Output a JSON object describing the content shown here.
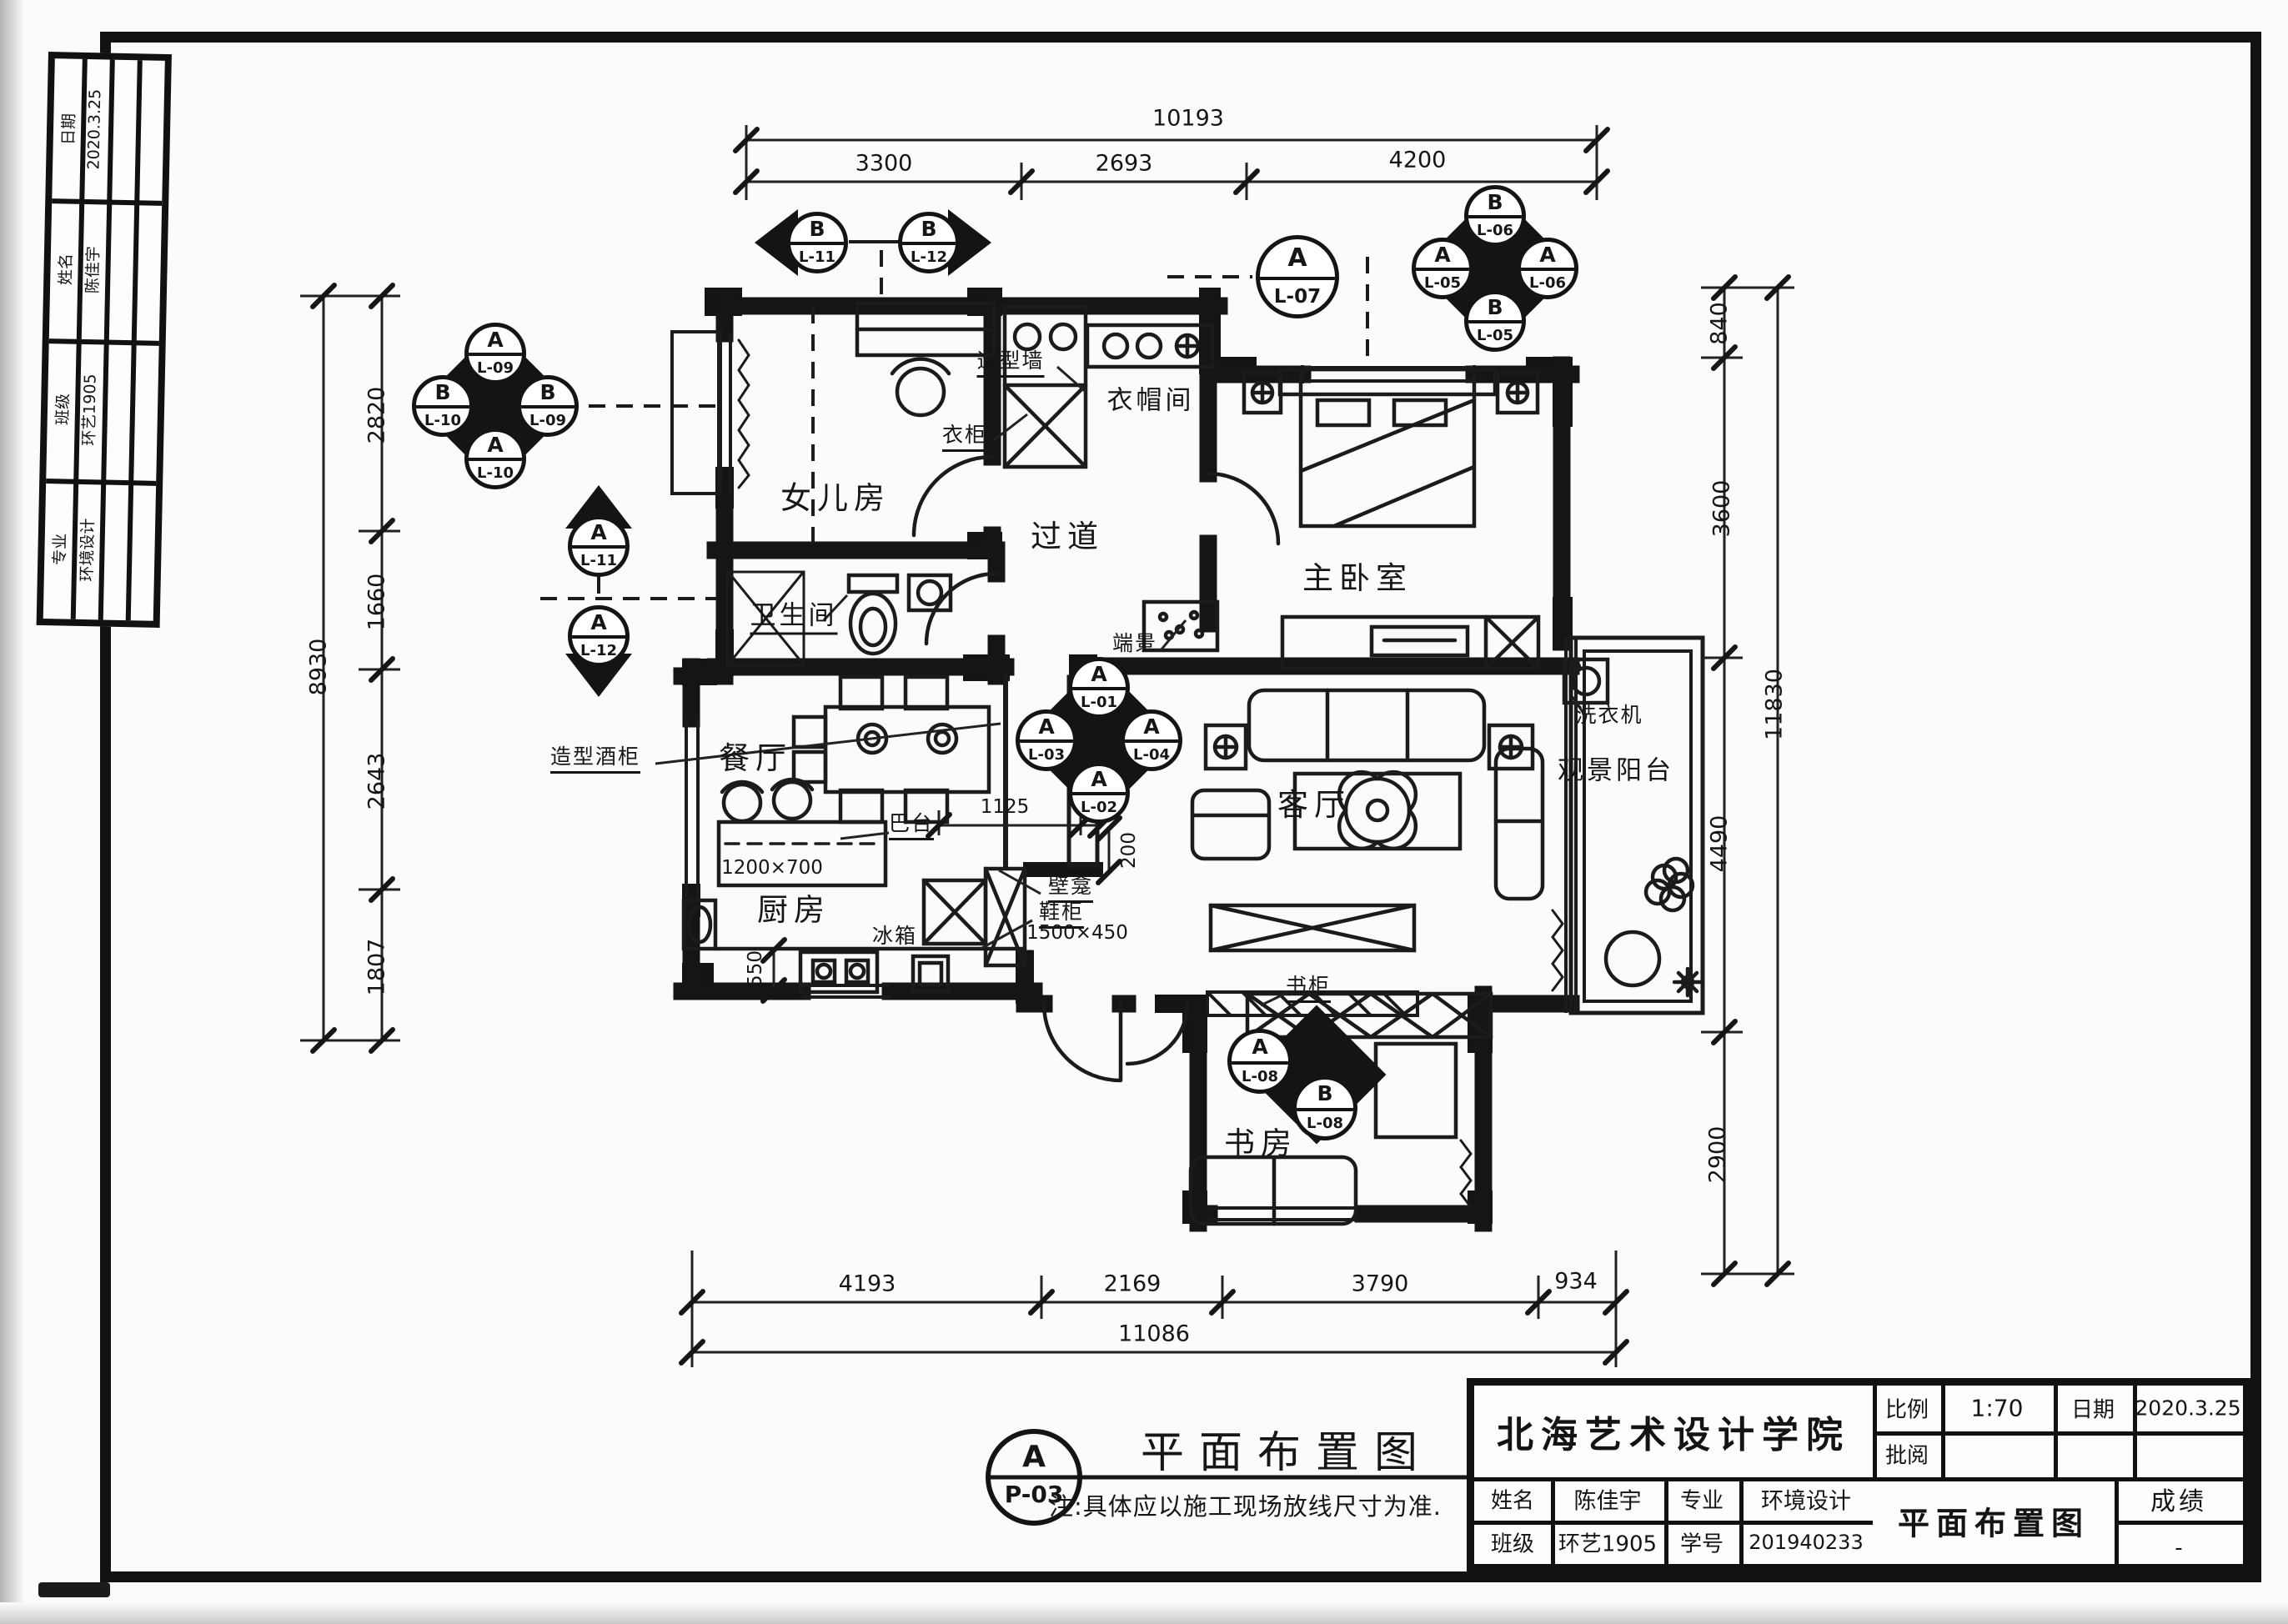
{
  "page": {
    "anno": {
      "circle_top": "A",
      "circle_bottom": "P-03",
      "title": "平面布置图",
      "scale": "1:70",
      "note": "注:具体应以施工现场放线尺寸为准."
    },
    "titleblock": {
      "school": "北海艺术设计学院",
      "scale_label": "比例",
      "scale_value": "1:70",
      "date_label": "日期",
      "date_value": "2020.3.25",
      "review_label": "批阅",
      "name_label": "姓名",
      "name_value": "陈佳宇",
      "major_label": "专业",
      "major_value": "环境设计",
      "class_label": "班级",
      "class_value": "环艺1905",
      "sid_label": "学号",
      "sid_value": "201940233",
      "drawing_title": "平面布置图",
      "grade_label": "成绩",
      "grade_value": "-"
    },
    "strip": {
      "rows": [
        {
          "label": "日期",
          "value": "2020.3.25"
        },
        {
          "label": "姓名",
          "value": "陈佳宇"
        },
        {
          "label": "班级",
          "value": "环艺1905"
        },
        {
          "label": "专业",
          "value": "环境设计"
        }
      ]
    }
  },
  "rooms": {
    "daughter": "女儿房",
    "cloak": "衣帽间",
    "corridor": "过道",
    "bath": "卫生间",
    "master": "主卧室",
    "dining": "餐厅",
    "kitchen": "厨房",
    "living": "客厅",
    "study": "书房",
    "balcony": "观景阳台"
  },
  "labels": {
    "wardrobe": "衣柜",
    "feature_wall": "造型墙",
    "end_vista": "端景",
    "wine_cabinet": "造型酒柜",
    "bar": "巴台",
    "bar_size": "1200×700",
    "fridge": "冰箱",
    "niche": "壁龛",
    "shoe_cabinet": "鞋柜",
    "shoe_size": "1500×450",
    "bookcase": "书柜",
    "washer": "洗衣机"
  },
  "dims": {
    "top": {
      "overall": "10193",
      "seg": [
        "3300",
        "2693",
        "4200"
      ]
    },
    "bottom": {
      "overall": "11086",
      "seg": [
        "4193",
        "2169",
        "3790",
        "934"
      ]
    },
    "left": {
      "overall": "8930",
      "seg": [
        "2820",
        "1660",
        "2643",
        "1807"
      ]
    },
    "right": {
      "overall": "11830",
      "seg": [
        "840",
        "3600",
        "4490",
        "2900"
      ]
    },
    "inner": {
      "a": "1125",
      "b": "240",
      "c": "200",
      "d": "550"
    }
  },
  "markers": {
    "tr": {
      "n_l": "B",
      "n_c": "L-06",
      "w_l": "A",
      "w_c": "L-05",
      "e_l": "A",
      "e_c": "L-06",
      "s_l": "B",
      "s_c": "L-05"
    },
    "lf": {
      "n_l": "A",
      "n_c": "L-09",
      "w_l": "B",
      "w_c": "L-10",
      "e_l": "B",
      "e_c": "L-09",
      "s_l": "A",
      "s_c": "L-10"
    },
    "ct": {
      "n_l": "A",
      "n_c": "L-01",
      "w_l": "A",
      "w_c": "L-03",
      "e_l": "A",
      "e_c": "L-04",
      "s_l": "A",
      "s_c": "L-02"
    },
    "up": {
      "l": "A",
      "c": "L-11"
    },
    "dn": {
      "l": "A",
      "c": "L-12"
    },
    "we": {
      "l": "B",
      "c": "L-11"
    },
    "ea": {
      "l": "B",
      "c": "L-12"
    },
    "single": {
      "l": "A",
      "c": "L-07"
    },
    "study_a": {
      "l": "A",
      "c": "L-08"
    },
    "study_b": {
      "l": "B",
      "c": "L-08"
    }
  }
}
